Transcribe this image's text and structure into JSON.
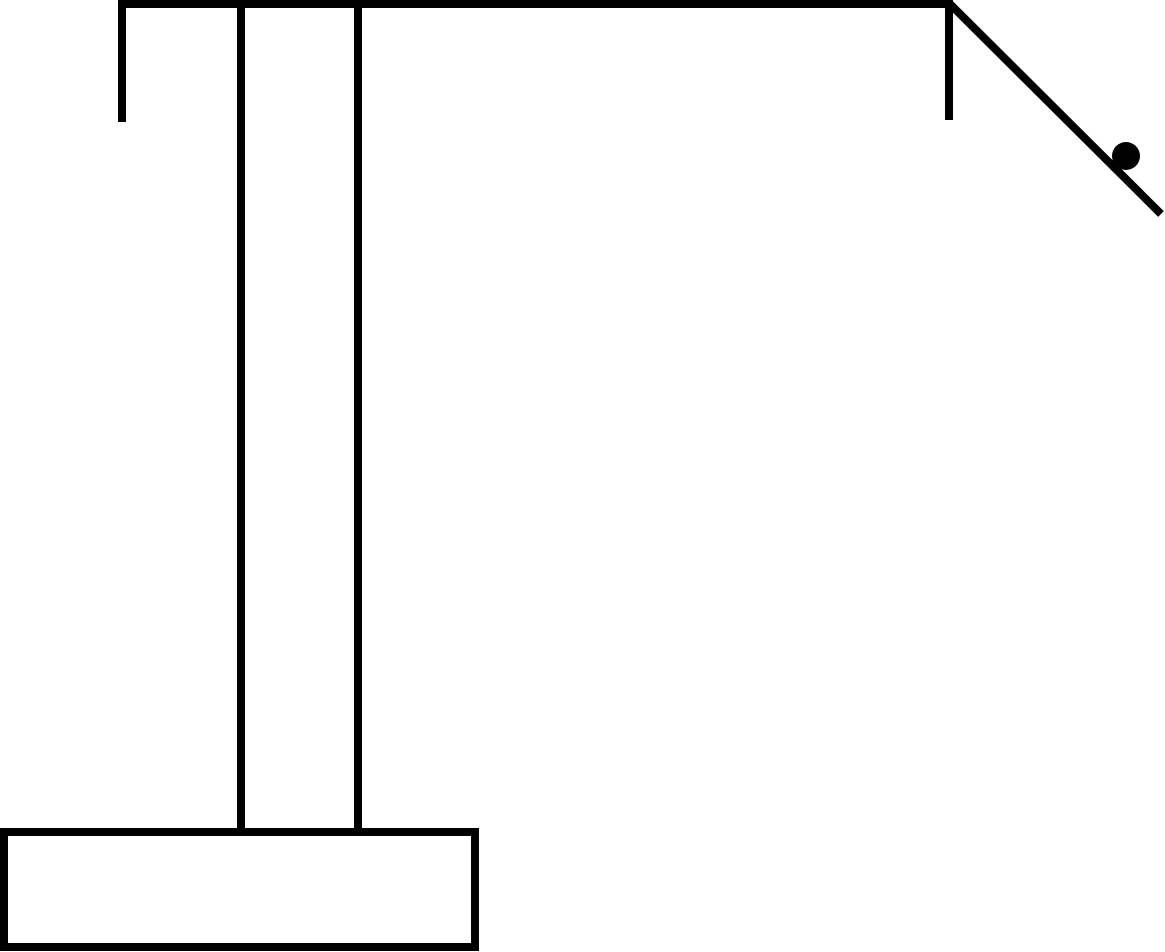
{
  "canvas": {
    "width": 1165,
    "height": 952,
    "background": "#ffffff",
    "ink_color": "#000000"
  },
  "figure": {
    "description": "Black-and-white line diagram: a pedestal base with a tall vertical column supporting a horizontal overhead beam; short brackets hang from each end of the beam, and an inclined ramp descends from the beam's right end with a solid ball resting on the incline",
    "shapes": [
      {
        "name": "top-beam",
        "type": "rect",
        "x": 118,
        "y": 0,
        "width": 834,
        "height": 8,
        "fill": "#000000"
      },
      {
        "name": "left-bracket",
        "type": "rect",
        "x": 118,
        "y": 0,
        "width": 8,
        "height": 122,
        "fill": "#000000"
      },
      {
        "name": "right-bracket",
        "type": "rect",
        "x": 945,
        "y": 0,
        "width": 8,
        "height": 120,
        "fill": "#000000"
      },
      {
        "name": "column-left-edge",
        "type": "rect",
        "x": 237,
        "y": 0,
        "width": 8,
        "height": 828,
        "fill": "#000000"
      },
      {
        "name": "column-right-edge",
        "type": "rect",
        "x": 354,
        "y": 0,
        "width": 8,
        "height": 828,
        "fill": "#000000"
      },
      {
        "name": "base-pedestal",
        "type": "rect-outline",
        "x": 4,
        "y": 832,
        "width": 471,
        "height": 115,
        "fill": "#ffffff",
        "stroke": "#000000",
        "stroke_width": 8
      },
      {
        "name": "ramp-incline",
        "type": "line",
        "x1": 950,
        "y1": 4,
        "x2": 1161,
        "y2": 214,
        "stroke": "#000000",
        "stroke_width": 8
      },
      {
        "name": "ball",
        "type": "circle",
        "cx": 1126,
        "cy": 156,
        "r": 14,
        "fill": "#000000"
      }
    ]
  }
}
